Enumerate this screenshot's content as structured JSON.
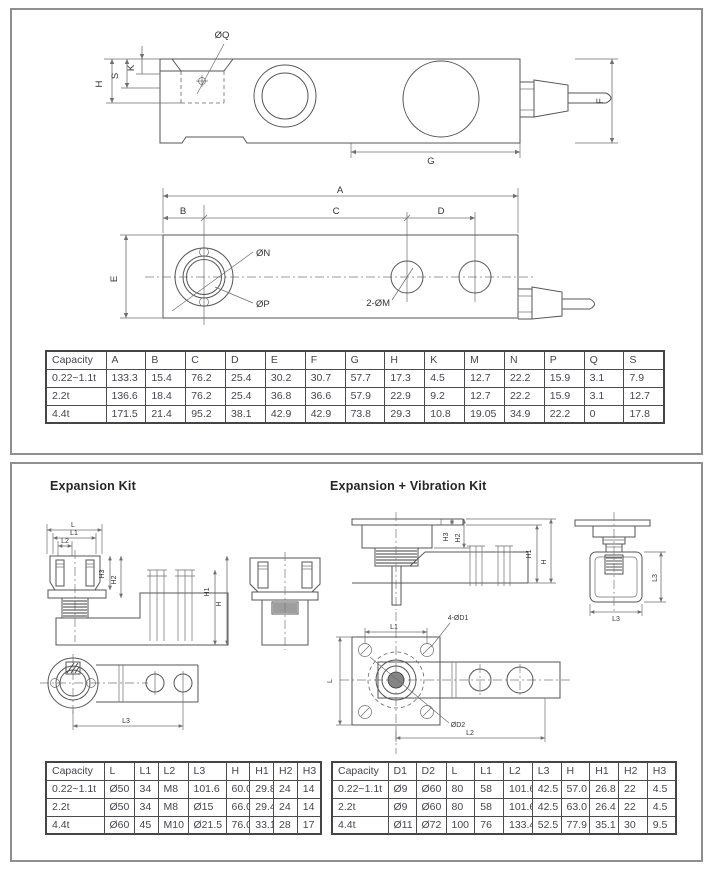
{
  "panel_top": {
    "side_labels": {
      "oq": "ØQ",
      "s": "S",
      "k": "K",
      "h": "H",
      "f": "F",
      "g": "G"
    },
    "plan_labels": {
      "a": "A",
      "b": "B",
      "c": "C",
      "d": "D",
      "e": "E",
      "on": "ØN",
      "op": "ØP",
      "two_m": "2-ØM"
    },
    "table": {
      "headers": [
        "Capacity",
        "A",
        "B",
        "C",
        "D",
        "E",
        "F",
        "G",
        "H",
        "K",
        "M",
        "N",
        "P",
        "Q",
        "S"
      ],
      "rows": [
        [
          "0.22~1.1t",
          "133.3",
          "15.4",
          "76.2",
          "25.4",
          "30.2",
          "30.7",
          "57.7",
          "17.3",
          "4.5",
          "12.7",
          "22.2",
          "15.9",
          "3.1",
          "7.9"
        ],
        [
          "2.2t",
          "136.6",
          "18.4",
          "76.2",
          "25.4",
          "36.8",
          "36.6",
          "57.9",
          "22.9",
          "9.2",
          "12.7",
          "22.2",
          "15.9",
          "3.1",
          "12.7"
        ],
        [
          "4.4t",
          "171.5",
          "21.4",
          "95.2",
          "38.1",
          "42.9",
          "42.9",
          "73.8",
          "29.3",
          "10.8",
          "19.05",
          "34.9",
          "22.2",
          "0",
          "17.8"
        ]
      ]
    }
  },
  "panel_bottom": {
    "expansion_title": "Expansion Kit",
    "vibration_title": "Expansion + Vibration Kit",
    "labels": {
      "l": "L",
      "l1": "L1",
      "l2": "L2",
      "l3": "L3",
      "h": "H",
      "h1": "H1",
      "h2": "H2",
      "h3": "H3",
      "four_d1": "4-ØD1",
      "d2": "ØD2"
    },
    "expansion_table": {
      "headers": [
        "Capacity",
        "L",
        "L1",
        "L2",
        "L3",
        "H",
        "H1",
        "H2",
        "H3"
      ],
      "rows": [
        [
          "0.22~1.1t",
          "Ø50",
          "34",
          "M8",
          "101.6",
          "60.0",
          "29.8",
          "24",
          "14"
        ],
        [
          "2.2t",
          "Ø50",
          "34",
          "M8",
          "Ø15",
          "66.0",
          "29.4",
          "24",
          "14"
        ],
        [
          "4.4t",
          "Ø60",
          "45",
          "M10",
          "Ø21.5",
          "76.0",
          "33.1",
          "28",
          "17"
        ]
      ]
    },
    "vibration_table": {
      "headers": [
        "Capacity",
        "D1",
        "D2",
        "L",
        "L1",
        "L2",
        "L3",
        "H",
        "H1",
        "H2",
        "H3"
      ],
      "rows": [
        [
          "0.22~1.1t",
          "Ø9",
          "Ø60",
          "80",
          "58",
          "101.6",
          "42.5",
          "57.0",
          "26.8",
          "22",
          "4.5"
        ],
        [
          "2.2t",
          "Ø9",
          "Ø60",
          "80",
          "58",
          "101.6",
          "42.5",
          "63.0",
          "26.4",
          "22",
          "4.5"
        ],
        [
          "4.4t",
          "Ø11",
          "Ø72",
          "100",
          "76",
          "133.4",
          "52.5",
          "77.9",
          "35.1",
          "30",
          "9.5"
        ]
      ]
    }
  },
  "colors": {
    "line": "#555555",
    "dim": "#707070",
    "text": "#45454e",
    "panel_border": "#8f8f8f"
  }
}
